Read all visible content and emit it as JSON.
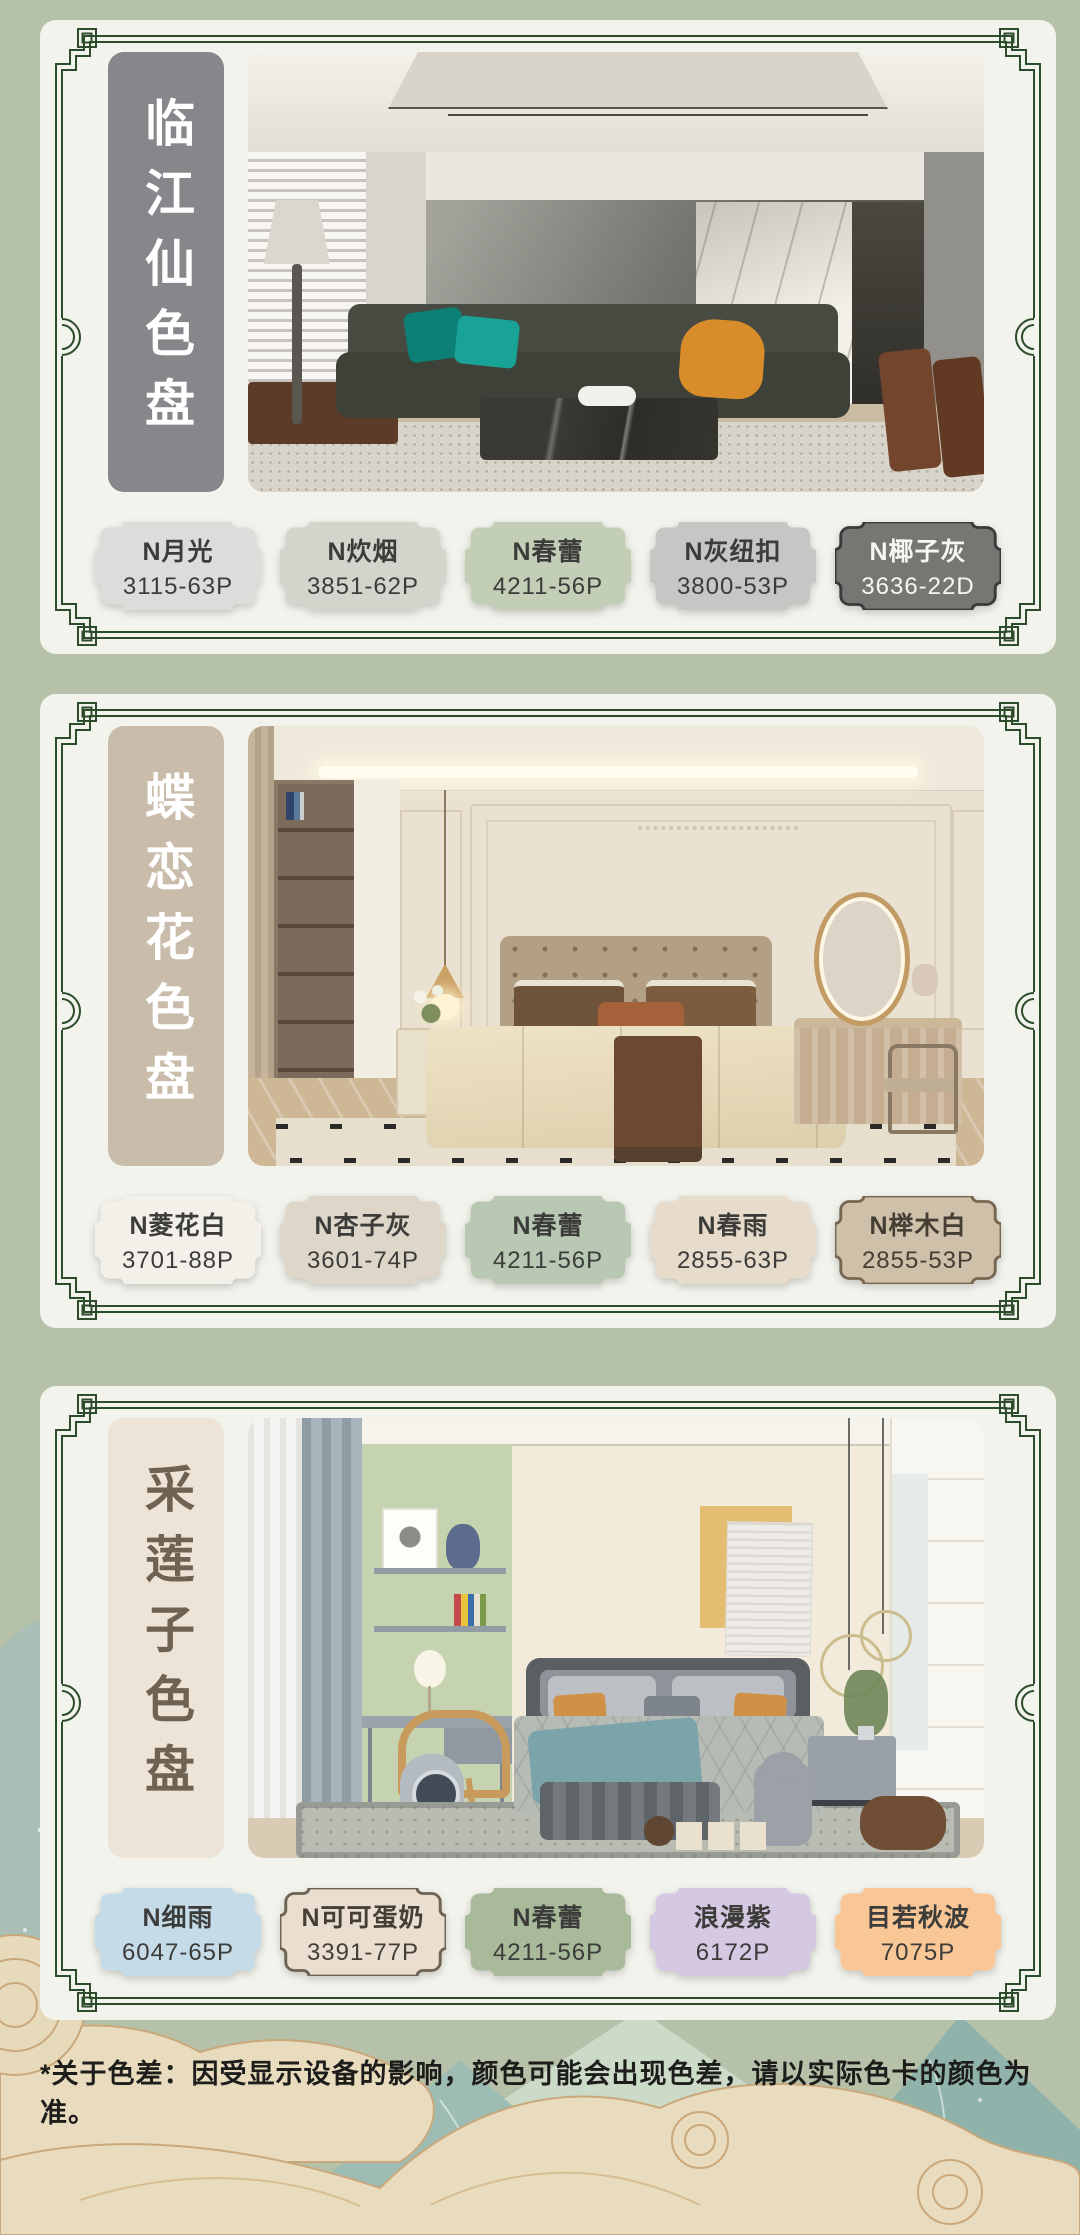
{
  "page": {
    "bg_color": "#b6c1aa",
    "card_bg": "#f2f3ed",
    "frame_color": "#2d4c2a",
    "disclaimer": "*关于色差：因受显示设备的影响，颜色可能会出现色差，请以实际色卡的颜色为准。"
  },
  "palettes": [
    {
      "title": "临江仙色盘",
      "banner": {
        "bg": "#85878a",
        "text": "#ffffff"
      },
      "photo_description": "dark modern living room with green sofa, teal pillows, orange throw, marble panel",
      "swatches": [
        {
          "name": "N月光",
          "code": "3115-63P",
          "color": "#dcdcda",
          "text": "#3c3c3a"
        },
        {
          "name": "N炊烟",
          "code": "3851-62P",
          "color": "#d5d4cc",
          "text": "#3c3c3a"
        },
        {
          "name": "N春蕾",
          "code": "4211-56P",
          "color": "#c2ceb6",
          "text": "#3c3c3a"
        },
        {
          "name": "N灰纽扣",
          "code": "3800-53P",
          "color": "#c6c6c4",
          "text": "#3c3c3a"
        },
        {
          "name": "N椰子灰",
          "code": "3636-22D",
          "color": "#767673",
          "text": "#f6f6f3",
          "border": "#3a3a3c"
        }
      ]
    },
    {
      "title": "蝶恋花色盘",
      "banner": {
        "bg": "#c9bcab",
        "text": "#ffffff"
      },
      "photo_description": "french cream bedroom with tufted headboard, brown pillows, striped armchair, oval mirror",
      "swatches": [
        {
          "name": "N菱花白",
          "code": "3701-88P",
          "color": "#f3f0e9",
          "text": "#3c3c3a"
        },
        {
          "name": "N杏子灰",
          "code": "3601-74P",
          "color": "#ded7c9",
          "text": "#3c3c3a"
        },
        {
          "name": "N春蕾",
          "code": "4211-56P",
          "color": "#b8c8b2",
          "text": "#3c3c3a"
        },
        {
          "name": "N春雨",
          "code": "2855-63P",
          "color": "#e7dbcc",
          "text": "#3c3c3a"
        },
        {
          "name": "N榉木白",
          "code": "2855-53P",
          "color": "#cfc0aa",
          "text": "#453e34",
          "border": "#786750"
        }
      ]
    },
    {
      "title": "采莲子色盘",
      "banner": {
        "bg": "#ede3d6",
        "text": "#6e6352"
      },
      "photo_description": "kids bedroom with sage accent wall, gray bed, teal throw, toys, yellow wall art",
      "swatches": [
        {
          "name": "N细雨",
          "code": "6047-65P",
          "color": "#c5dce8",
          "text": "#3c3c3a"
        },
        {
          "name": "N可可蛋奶",
          "code": "3391-77P",
          "color": "#e9decf",
          "text": "#453e34",
          "border": "#6f6252"
        },
        {
          "name": "N春蕾",
          "code": "4211-56P",
          "color": "#a9ba9b",
          "text": "#3c3c3a"
        },
        {
          "name": "浪漫紫",
          "code": "6172P",
          "color": "#d5c8e2",
          "text": "#3c3c3a"
        },
        {
          "name": "目若秋波",
          "code": "7075P",
          "color": "#f9c795",
          "text": "#3c3c3a"
        }
      ]
    }
  ]
}
